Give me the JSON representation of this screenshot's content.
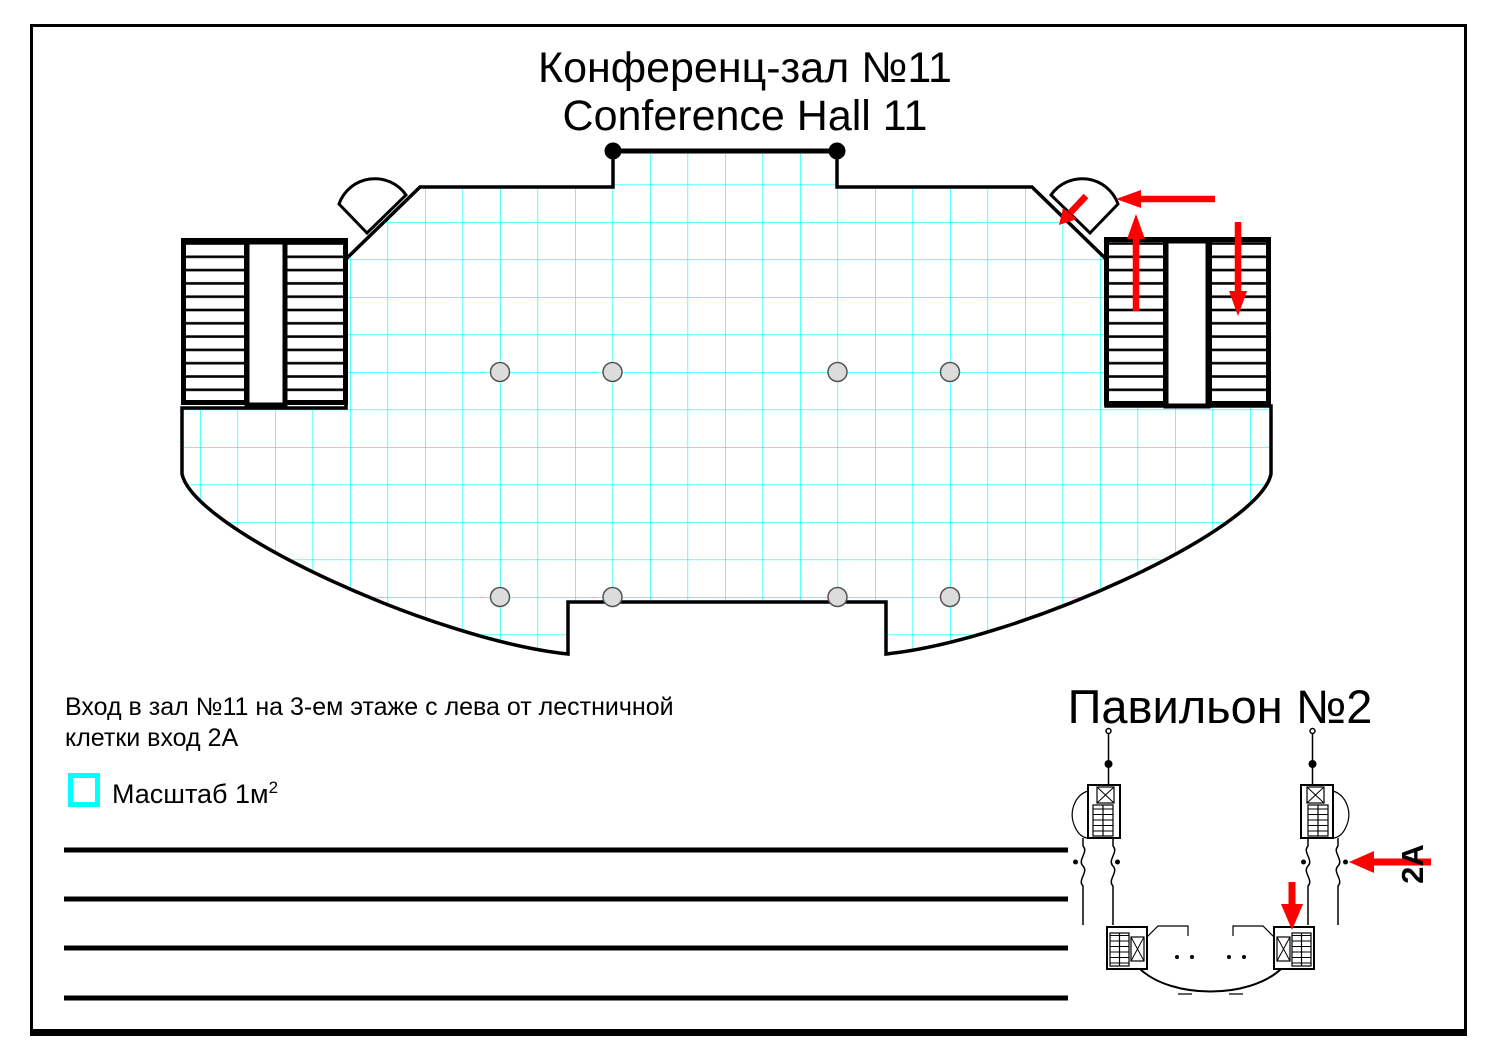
{
  "header": {
    "title_ru": "Конференц-зал №11",
    "title_en": "Conference Hall 11"
  },
  "note": {
    "line1": "Вход в зал №11 на 3-ем этаже с лева от лестничной",
    "line2": "клетки вход 2А"
  },
  "legend": {
    "label": "Масштаб 1м",
    "sup": "2"
  },
  "inset": {
    "title": "Павильон №2",
    "entrance_label": "2A"
  },
  "colors": {
    "grid": "#00ffff",
    "arrow": "#ff0000",
    "wall": "#000000",
    "column_fill": "#dcdcdc"
  }
}
